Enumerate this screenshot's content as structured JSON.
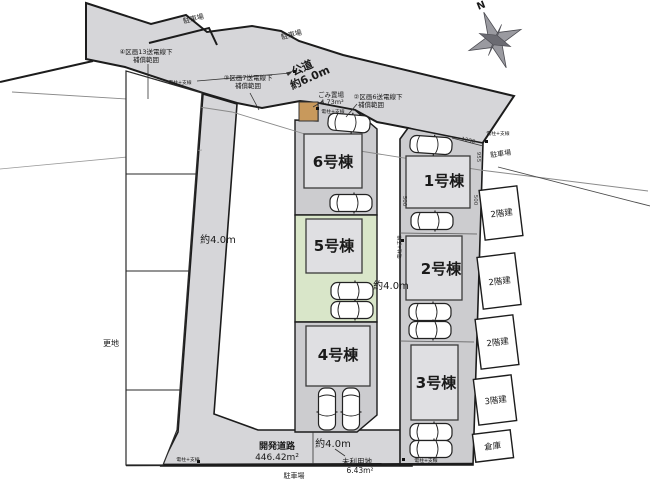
{
  "plan": {
    "compass": {
      "north": "N"
    },
    "labels": {
      "parking": "駐車場",
      "vacant": "更地",
      "dev_road_1": "開発道路",
      "dev_road_2": "446.42m²",
      "public_road_1": "公道",
      "public_road_2": "約6.0m",
      "width_4m": "約4.0m",
      "trash_1": "ごみ置場",
      "trash_2": "4.73m²",
      "unused_1": "未利用地",
      "unused_2": "6.43m²",
      "pole": "電柱+支線",
      "zone2_1": "②区画6送電線下",
      "zone2_2": "補償範囲",
      "zone3_1": "③区画7送電線下",
      "zone3_2": "補償範囲",
      "zone4_1": "④区画13送電線下",
      "zone4_2": "補償範囲"
    },
    "buildings": {
      "b1": "1号棟",
      "b2": "2号棟",
      "b3": "3号棟",
      "b4": "4号棟",
      "b5": "5号棟",
      "b6": "6号棟"
    },
    "neighbors": {
      "n1": "2階建",
      "n2": "2階建",
      "n3": "2階建",
      "n4": "3階建",
      "n5": "倉庫"
    },
    "dims": {
      "d1230": "1230",
      "d955": "955",
      "d500": "500"
    },
    "colors": {
      "road": "#d6d6d9",
      "driveway": "#cccccf",
      "building": "#dfdfe2",
      "selected_green": "#d9e6c9",
      "trash_tan": "#c8995c",
      "line": "#1c1c1c"
    }
  }
}
